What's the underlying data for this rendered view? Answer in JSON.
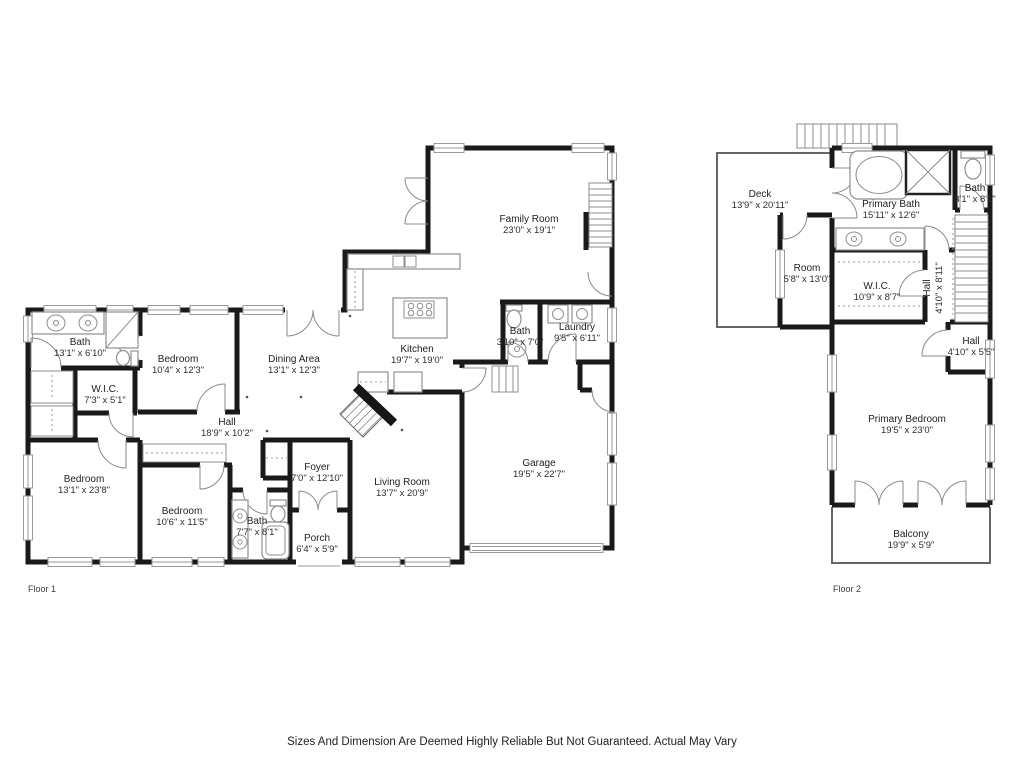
{
  "disclaimer": "Sizes And Dimension Are Deemed Highly Reliable But Not Guaranteed. Actual May Vary",
  "colors": {
    "wall": "#1a1a1a",
    "fixture": "#8f8f8f",
    "window": "#9a9a9a",
    "text": "#222222"
  },
  "floor1": {
    "label": "Floor 1",
    "rooms": {
      "bath1": {
        "name": "Bath",
        "dims": "13'1\" x 6'10\""
      },
      "bedroom1": {
        "name": "Bedroom",
        "dims": "10'4\" x 12'3\""
      },
      "wic": {
        "name": "W.I.C.",
        "dims": "7'3\" x 5'1\""
      },
      "hall": {
        "name": "Hall",
        "dims": "18'9\" x 10'2\""
      },
      "dining": {
        "name": "Dining Area",
        "dims": "13'1\" x 12'3\""
      },
      "kitchen": {
        "name": "Kitchen",
        "dims": "19'7\" x 19'0\""
      },
      "family": {
        "name": "Family Room",
        "dims": "23'0\" x 19'1\""
      },
      "bath2": {
        "name": "Bath",
        "dims": "3'10\" x 7'0\""
      },
      "laundry": {
        "name": "Laundry",
        "dims": "9'5\" x 6'11\""
      },
      "garage": {
        "name": "Garage",
        "dims": "19'5\" x 22'7\""
      },
      "living": {
        "name": "Living Room",
        "dims": "13'7\" x 20'9\""
      },
      "foyer": {
        "name": "Foyer",
        "dims": "7'0\" x 12'10\""
      },
      "porch": {
        "name": "Porch",
        "dims": "6'4\" x 5'9\""
      },
      "bedroom2": {
        "name": "Bedroom",
        "dims": "13'1\" x 23'8\""
      },
      "bedroom3": {
        "name": "Bedroom",
        "dims": "10'6\" x 11'5\""
      },
      "bath3": {
        "name": "Bath",
        "dims": "7'7\" x 8'1\""
      }
    }
  },
  "floor2": {
    "label": "Floor 2",
    "rooms": {
      "deck": {
        "name": "Deck",
        "dims": "13'9\" x 20'11\""
      },
      "primary_bath": {
        "name": "Primary Bath",
        "dims": "15'11\" x 12'6\""
      },
      "bath": {
        "name": "Bath",
        "dims": "3'1\" x 8'1\""
      },
      "room": {
        "name": "Room",
        "dims": "5'8\" x 13'0\""
      },
      "wic": {
        "name": "W.I.C.",
        "dims": "10'9\" x 8'7\""
      },
      "hall_upper": {
        "name": "Hall",
        "dims": "4'10\" x 8'11\""
      },
      "hall_lower": {
        "name": "Hall",
        "dims": "4'10\" x 5'5\""
      },
      "primary_bedroom": {
        "name": "Primary Bedroom",
        "dims": "19'5\" x 23'0\""
      },
      "balcony": {
        "name": "Balcony",
        "dims": "19'9\" x 5'9\""
      }
    }
  }
}
